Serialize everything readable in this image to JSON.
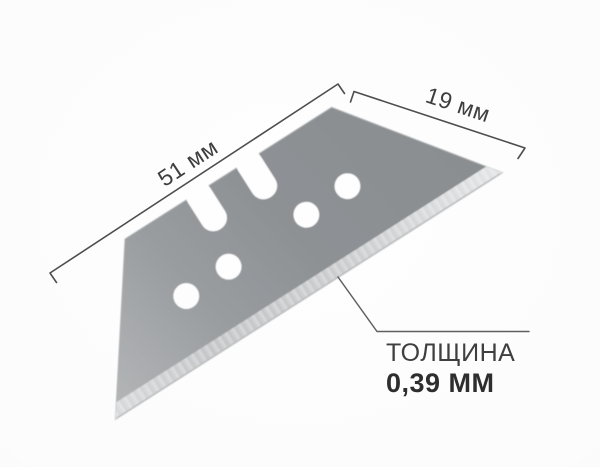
{
  "diagram": {
    "length_label": "51 мм",
    "width_label": "19 мм",
    "thickness_label": "ТОЛЩИНА",
    "thickness_value": "0,39 ММ"
  },
  "colors": {
    "background": "#fcfcfc",
    "blade_body": "#8e9194",
    "blade_body_light": "#b4b6b8",
    "blade_bevel": "#c8cacc",
    "dimension_line": "#4e4e4e",
    "leader_line": "#5f5f5f",
    "text_primary": "#3f3f3f",
    "text_bold": "#2e2e2e"
  }
}
